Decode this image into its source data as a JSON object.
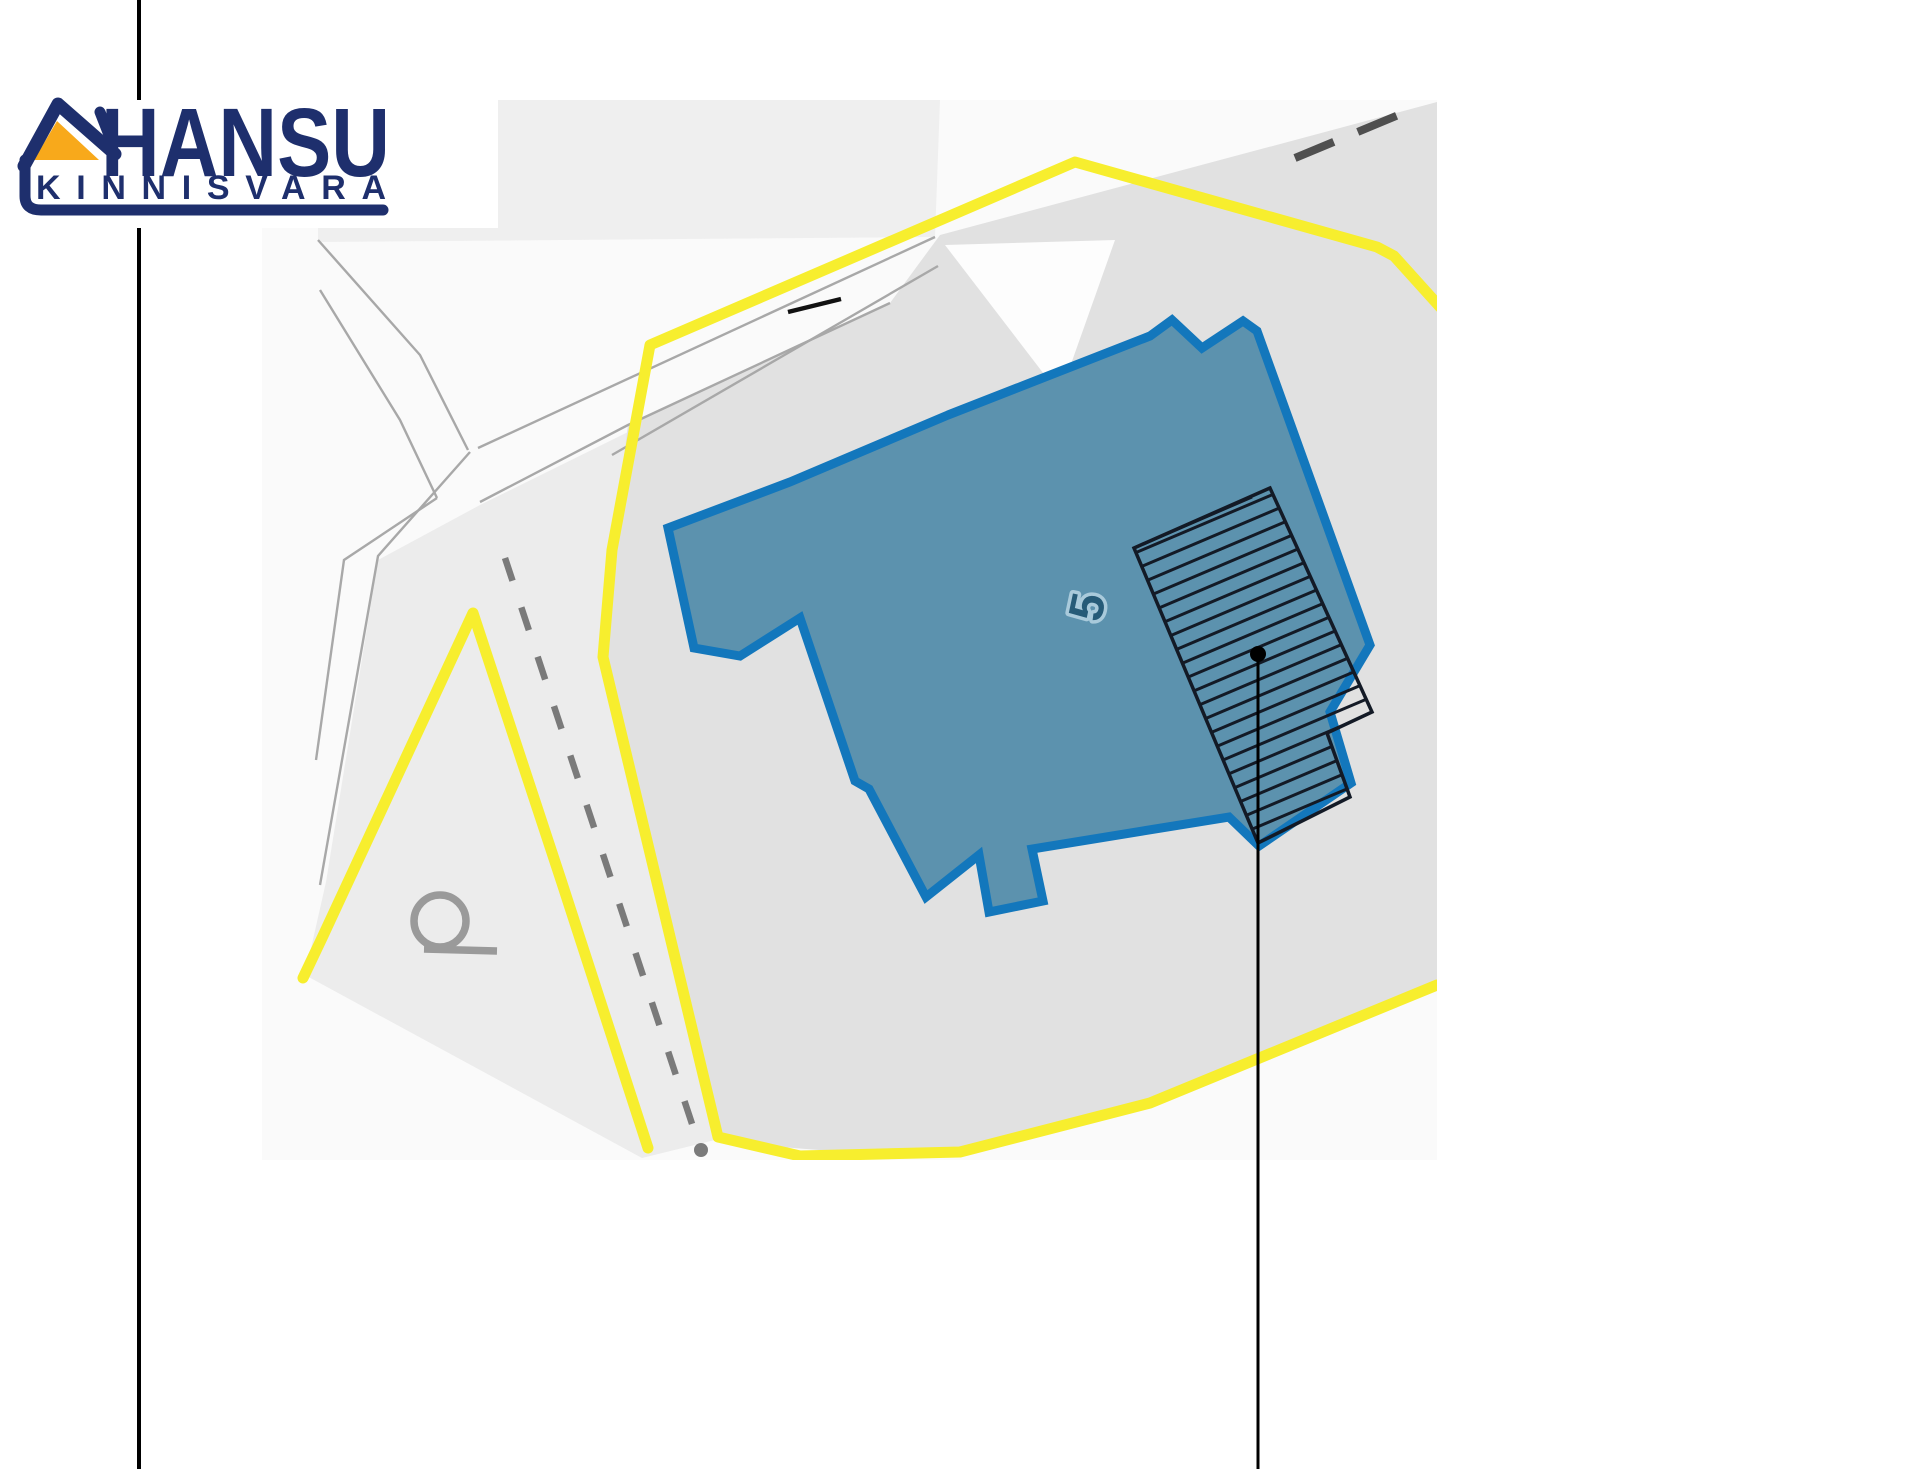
{
  "page": {
    "background": "#ffffff"
  },
  "logo": {
    "brand": "HANSU",
    "subtitle": "KINNISVARA",
    "colors": {
      "navy": "#1e2f6d",
      "orange": "#f8a91b",
      "background": "#ffffff"
    }
  },
  "map": {
    "building_label": "5",
    "road_label": "Q",
    "colors": {
      "map_background": "#fafafa",
      "upper_parcel": "#efefef",
      "parcel_light": "#ececec",
      "parcel_main": "#e1e1e1",
      "white_wedge": "#fdfdfd",
      "road_edge": "#a8a8a8",
      "boundary_yellow": "#f7ee2e",
      "cadastral_dash": "#4f4f4f",
      "footpath_dash": "#7a7a7a",
      "building_fill": "#5c92ae",
      "building_stroke": "#1377bc",
      "building_label_color": "#265b78",
      "building_label_halo": "#a9cadb",
      "hatch_color": "#131a26",
      "road_label_gray": "#9a9a9a",
      "road_mark_black": "#111111",
      "callout_black": "#000000"
    }
  }
}
